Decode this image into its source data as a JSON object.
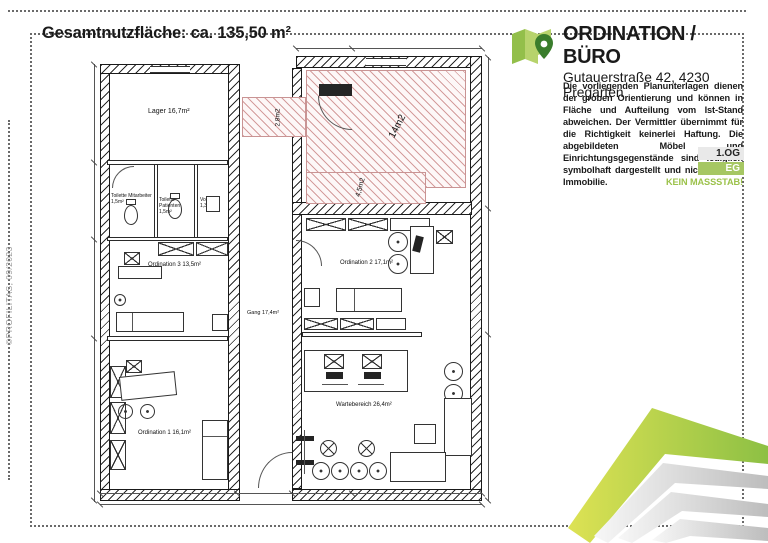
{
  "page": {
    "title": "Gesamtnutzfläche: ca. 135,50 m²",
    "watermark": "©PROFILITAS, 09/2023"
  },
  "header": {
    "title": "ORDINATION / BÜRO",
    "address": "Gutauerstraße 42, 4230 Pregarten",
    "logo_icon": "map-pin-icon"
  },
  "disclaimer": {
    "text": "Die vorliegenden Planunterlagen dienen der groben Orientierung und können in Fläche und Aufteilung vom Ist-Stand abweichen. Der Vermittler übernimmt für die Richtigkeit keinerlei Haftung. Die abgebildeten Möbel und Einrichtungsgegenstände sind lediglich symbolhaft dargestellt und nicht Teil der Immobilie.",
    "no_scale": "KEIN MASSSTAB!"
  },
  "floor_selector": {
    "upper": "1.OG",
    "ground": "EG"
  },
  "colors": {
    "accent_green": "#9cc24b",
    "badge_green": "#a6c763",
    "logo_light_green": "#b7d36c",
    "logo_mid_green": "#93bf4a",
    "logo_pin_green": "#3a7d2c",
    "hatch_pink": "#d49c9c",
    "plan_line": "#1a1a1a"
  },
  "plan": {
    "rooms": [
      {
        "label": "Lager 16,7m²"
      },
      {
        "label": "Toilette Mitarbeiter 1,5m²"
      },
      {
        "label": "Toilette Patienten 1,5m²"
      },
      {
        "label": "Vorraum 1,3m²"
      },
      {
        "label": "Ordination 3 13,5m²"
      },
      {
        "label": "Ordination 1 16,1m²"
      },
      {
        "label": "Gang 17,4m²"
      },
      {
        "label": "Ordination 2 17,1m²"
      },
      {
        "label": "Wartebereich 26,4m²"
      }
    ],
    "outdoor": [
      {
        "label": "2,8m2"
      },
      {
        "label": "14m2"
      },
      {
        "label": "4,5m2"
      }
    ]
  }
}
